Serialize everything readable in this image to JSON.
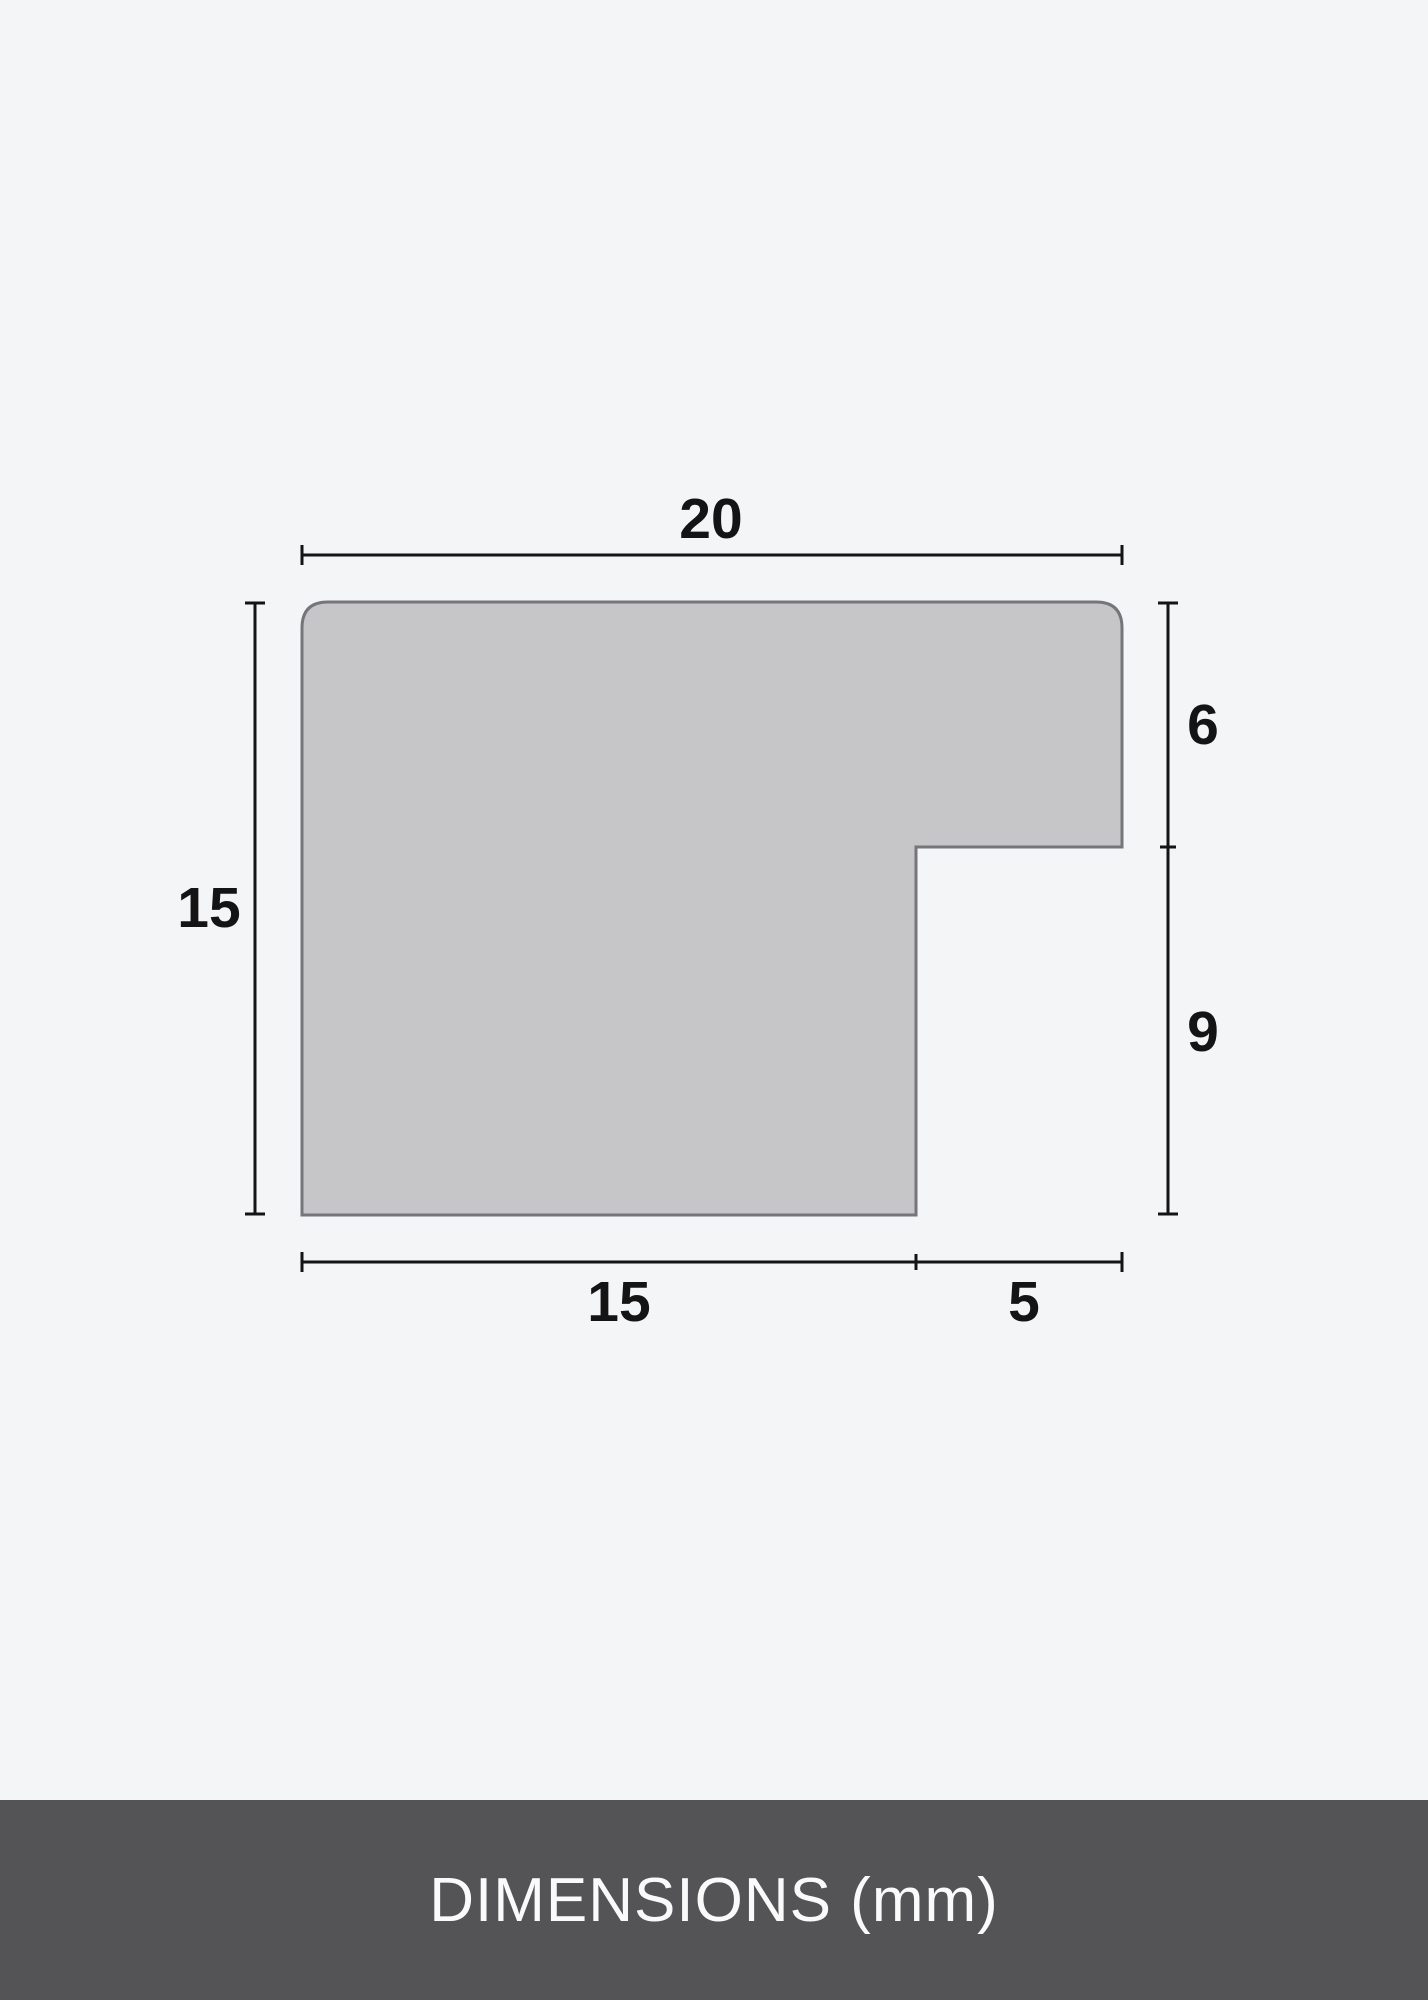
{
  "page": {
    "background_color": "#f4f5f7"
  },
  "diagram": {
    "unit": "mm",
    "shape": {
      "fill_color": "#c6c6c8",
      "stroke_color": "#75757a"
    },
    "line_color": "#141414",
    "labels": {
      "top_width": "20",
      "left_height": "15",
      "right_upper": "6",
      "right_lower": "9",
      "bottom_left": "15",
      "bottom_right": "5"
    },
    "values_mm": {
      "total_width": 20,
      "total_height": 15,
      "upper_depth": 6,
      "lower_depth": 9,
      "bottom_left_width": 15,
      "bottom_right_width": 5
    }
  },
  "footer": {
    "label": "DIMENSIONS (mm)",
    "background_color": "#545456",
    "text_color": "#fafafa"
  }
}
